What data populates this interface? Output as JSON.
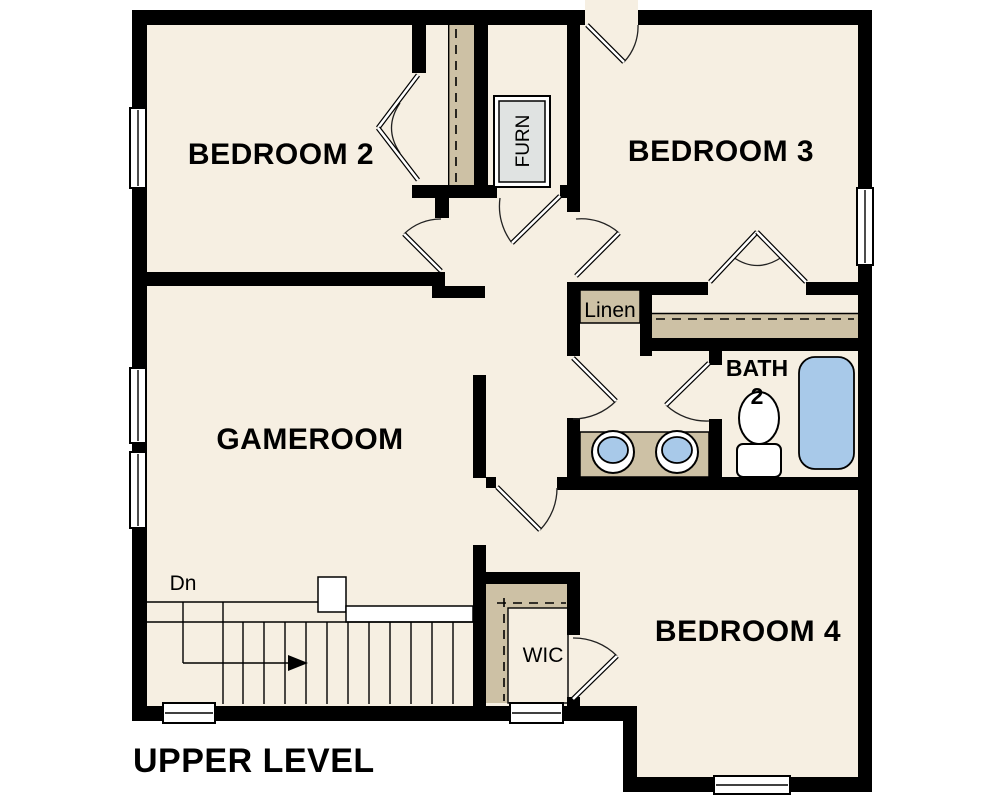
{
  "title": "UPPER LEVEL",
  "colors": {
    "floor": "#f6efe2",
    "closet": "#cdc1a5",
    "fixture": "#a8c9e9",
    "furn": "#e0e3e2",
    "wall": "#000000"
  },
  "rooms": {
    "bedroom2": {
      "label": "BEDROOM 2"
    },
    "bedroom3": {
      "label": "BEDROOM 3"
    },
    "gameroom": {
      "label": "GAMEROOM"
    },
    "bedroom4": {
      "label": "BEDROOM 4"
    },
    "bath": {
      "label_line1": "BATH",
      "label_line2": "2"
    },
    "linen": {
      "label": "Linen"
    },
    "wic": {
      "label": "WIC"
    },
    "furnace": {
      "label": "FURN"
    }
  },
  "stairs": {
    "down_label": "Dn"
  }
}
